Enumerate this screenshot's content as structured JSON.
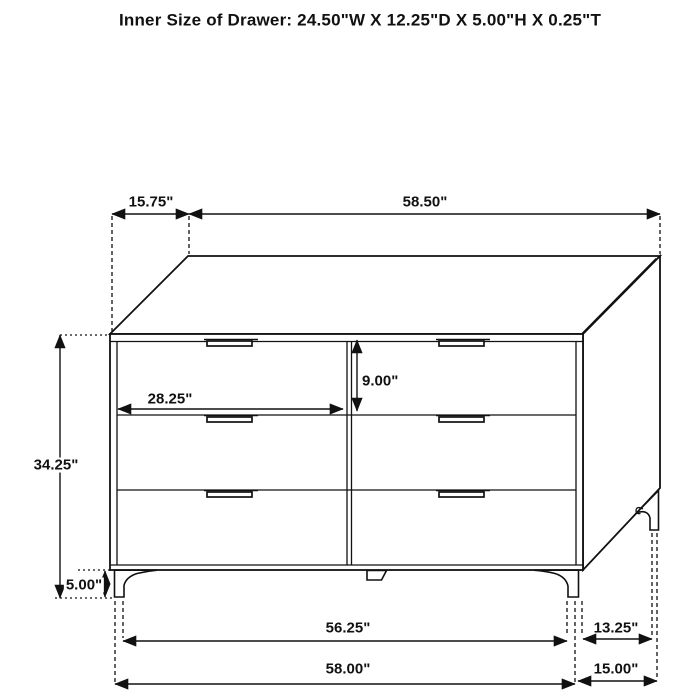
{
  "title": "Inner Size of Drawer: 24.50\"W X 12.25\"D X 5.00\"H X 0.25\"T",
  "colors": {
    "line": "#111111",
    "background": "#ffffff",
    "text": "#111111"
  },
  "figure": {
    "item": "six-drawer dresser",
    "drawer_rows": 3,
    "drawer_columns": 2
  },
  "dims": {
    "top_depth": "15.75\"",
    "top_width": "58.50\"",
    "drawer_inner_width": "28.25\"",
    "drawer_face_height": "9.00\"",
    "overall_height": "34.25\"",
    "leg_height": "5.00\"",
    "front_leg_span": "56.25\"",
    "overall_width": "58.00\"",
    "side_leg_span": "13.25\"",
    "overall_depth": "15.00\""
  }
}
